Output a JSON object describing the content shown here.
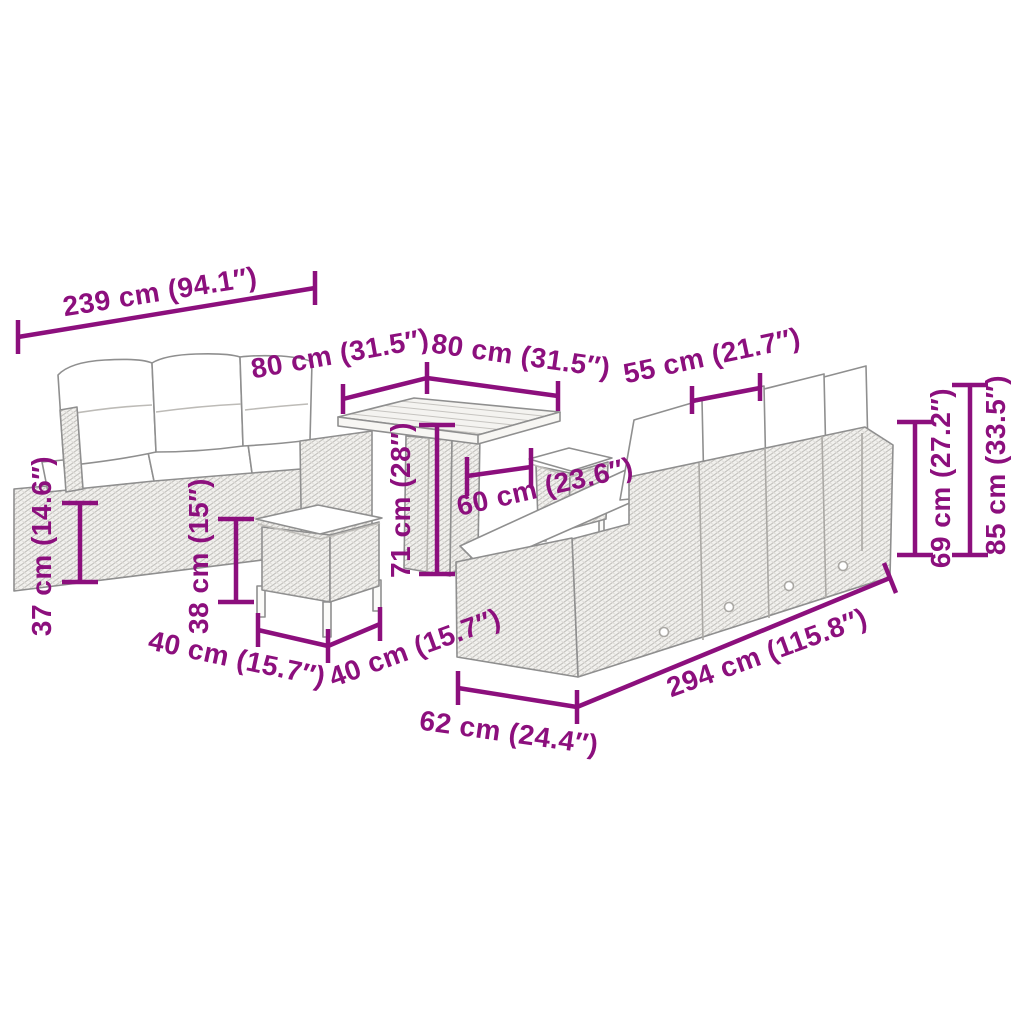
{
  "diagram": {
    "figure": "rattan garden lounge set line drawing (3-seater sofa, large corner sofa, square table, two stools with cushions)",
    "colors": {
      "dimension": "#8C0F7D",
      "outline": "#8f8f8f",
      "rattan_hatch": "#c2c0bc",
      "cushion": "#ffffff",
      "background": "#ffffff"
    },
    "units": [
      "cm",
      "inches"
    ],
    "dims": {
      "sofa_left_width": "239 cm (94.1″)",
      "table_side_left": "80 cm (31.5″)",
      "table_side_right": "80 cm (31.5″)",
      "back_cushion_width": "55 cm (21.7″)",
      "seat_back_height": "69 cm (27.2″)",
      "total_height": "85 cm (33.5″)",
      "base_height": "37 cm (14.6″)",
      "stool_height": "38 cm (15″)",
      "table_height": "71 cm (28″)",
      "table_depth": "60 cm (23.6″)",
      "stool_width": "40 cm (15.7″)",
      "stool_depth": "40 cm (15.7″)",
      "sofa_right_width": "294 cm (115.8″)",
      "chaise_depth": "62 cm (24.4″)"
    }
  }
}
